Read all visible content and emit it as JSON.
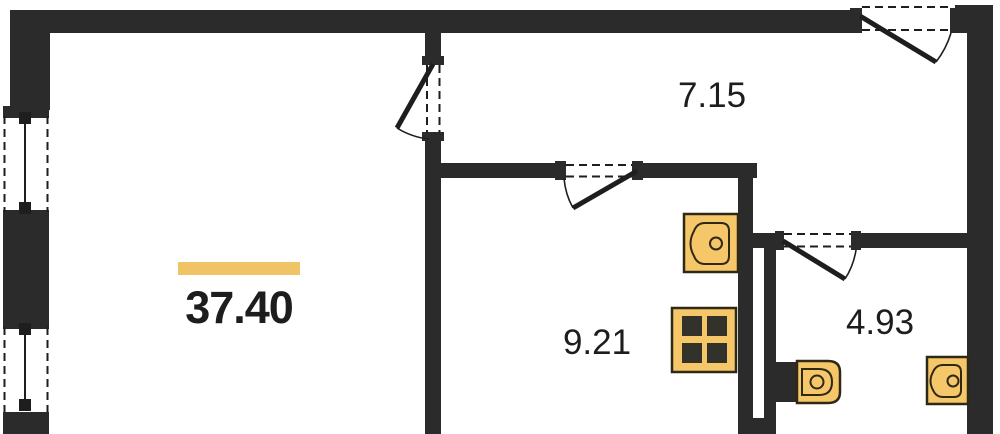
{
  "floor_plan": {
    "type": "apartment-floor-plan",
    "total_area": {
      "value": "37.40"
    },
    "rooms": [
      {
        "name": "hall",
        "area": "7.15"
      },
      {
        "name": "kitchen",
        "area": "9.21"
      },
      {
        "name": "bathroom",
        "area": "4.93"
      }
    ],
    "fixtures": [
      "kitchen-sink-icon",
      "stove-icon",
      "toilet-icon",
      "washbasin-icon"
    ],
    "openings": {
      "windows": 2,
      "door_swings": 4
    }
  },
  "colors": {
    "background": "#ffffff",
    "wall": "#2b2b2b",
    "line": "#1e1e1e",
    "text": "#1d1d1d",
    "accent_bar": "#f0c465",
    "fixture_fill": "#f6c768",
    "fixture_stroke": "#2e2817",
    "burner": "#33322a"
  }
}
